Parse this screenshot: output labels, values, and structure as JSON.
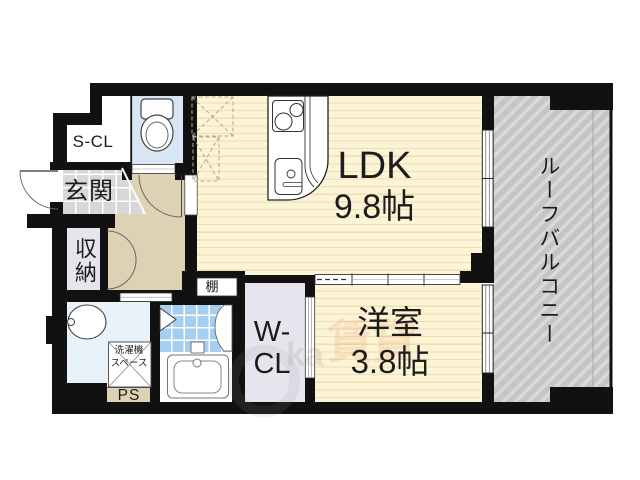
{
  "document": {
    "type": "apartment-floor-plan",
    "language": "ja"
  },
  "rooms": {
    "ldk": {
      "label": "LDK",
      "size": "9.8帖"
    },
    "bedroom": {
      "label": "洋室",
      "size": "3.8帖"
    },
    "roof_balcony": {
      "label": "ルーフバルコニー"
    },
    "entrance": {
      "label": "玄関"
    },
    "shoe_closet": {
      "label": "S-CL"
    },
    "storage": {
      "label": "収納"
    },
    "walk_in_closet": {
      "line1": "W-",
      "line2": "CL"
    },
    "shelf": {
      "label": "棚"
    },
    "pipe_space": {
      "label": "PS"
    },
    "laundry_space": {
      "line1": "洗濯機",
      "line2": "スペース"
    }
  },
  "fixtures": {
    "toilet": "toilet",
    "washbasin": "washbasin",
    "bathtub": "bathtub",
    "bath_door": "folding-door",
    "kitchen_stove": "two-burner-stove",
    "kitchen_sink": "kitchen-sink",
    "appliance_spaces": "dashed-placement-boxes"
  },
  "watermark": {
    "kanji": "賃貸",
    "latin": "ka"
  },
  "colors": {
    "wall": "#111111",
    "tatami_floor": "#fcf4d6",
    "floor_stripe": "#f0deac",
    "balcony": "#c5c5c5",
    "balcony_stripe": "#d9d9d9",
    "toilet_floor": "#d8e6f4",
    "washroom_floor": "#e9f1f9",
    "bath_tile": "#a6cef1",
    "entrance_floor": "#d7d7d7",
    "hallway_floor": "#ddd2b3",
    "closet_floor": "#e8e4ee",
    "ps_floor": "#ddd2b6"
  }
}
